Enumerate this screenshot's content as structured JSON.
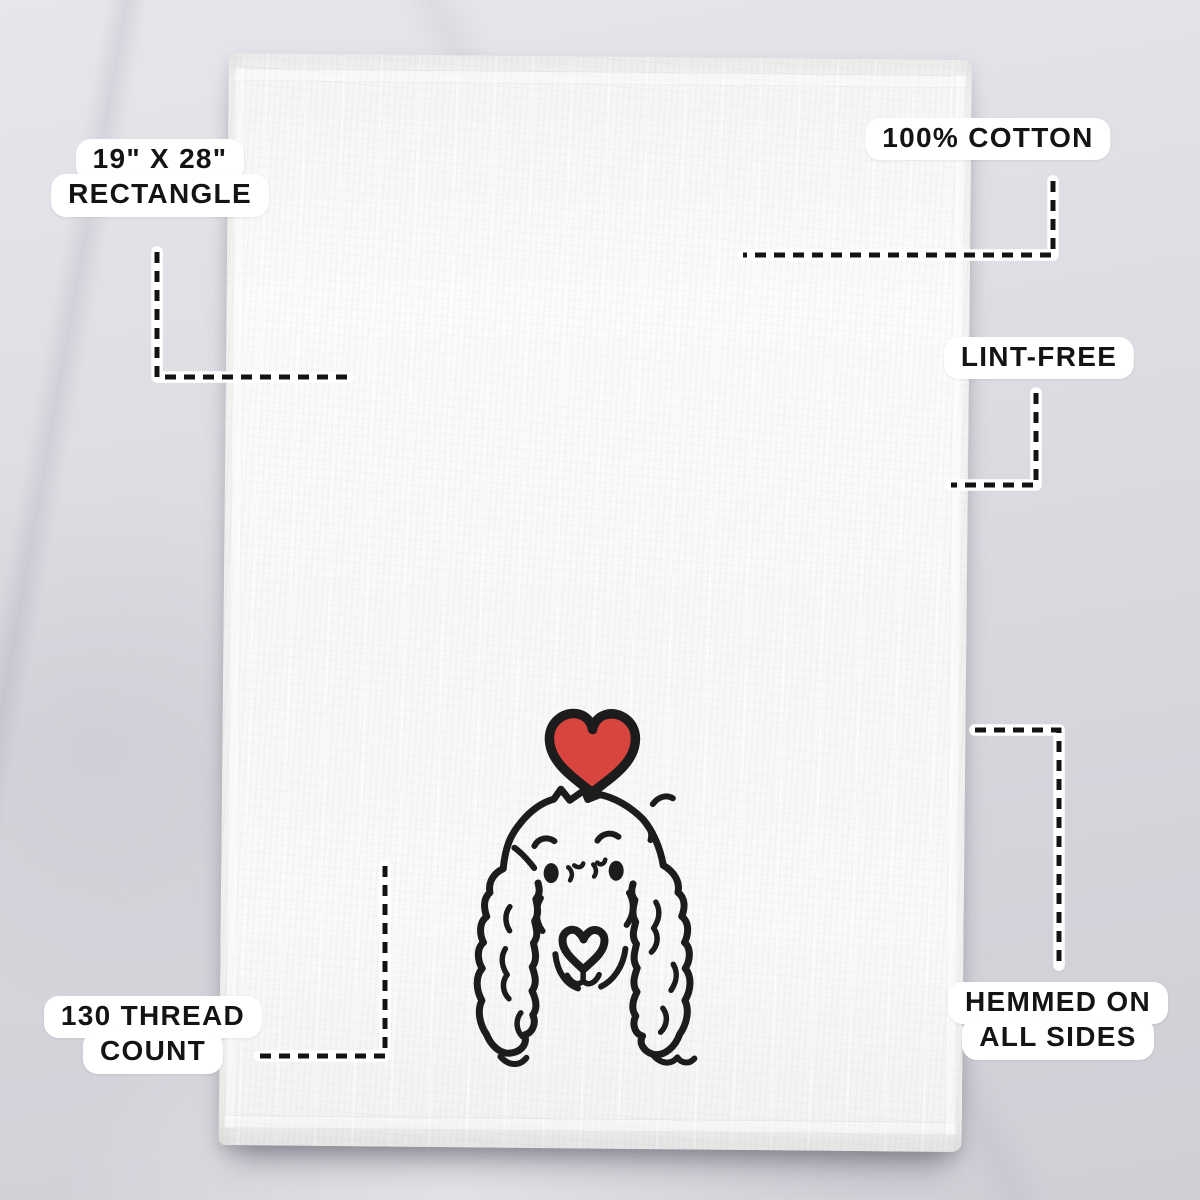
{
  "scene": {
    "type": "product-feature-infographic",
    "product": "white flour sack tea towel on marble surface",
    "print_subject": "Cocker Spaniel head line drawing with red heart above"
  },
  "callouts": {
    "size": {
      "lines": [
        "19\" X 28\"",
        "RECTANGLE"
      ]
    },
    "material": {
      "lines": [
        "100% COTTON"
      ]
    },
    "lint": {
      "lines": [
        "LINT-FREE"
      ]
    },
    "thread": {
      "lines": [
        "130 THREAD",
        "COUNT"
      ]
    },
    "hem": {
      "lines": [
        "HEMMED ON",
        "ALL SIDES"
      ]
    }
  },
  "colors": {
    "heart_red": "#d8453f",
    "ink_black": "#1c1c1c",
    "label_bg": "#ffffff",
    "label_text": "#141414",
    "towel_white": "#f9f9f8",
    "marble_gray": "#d9d8de"
  }
}
